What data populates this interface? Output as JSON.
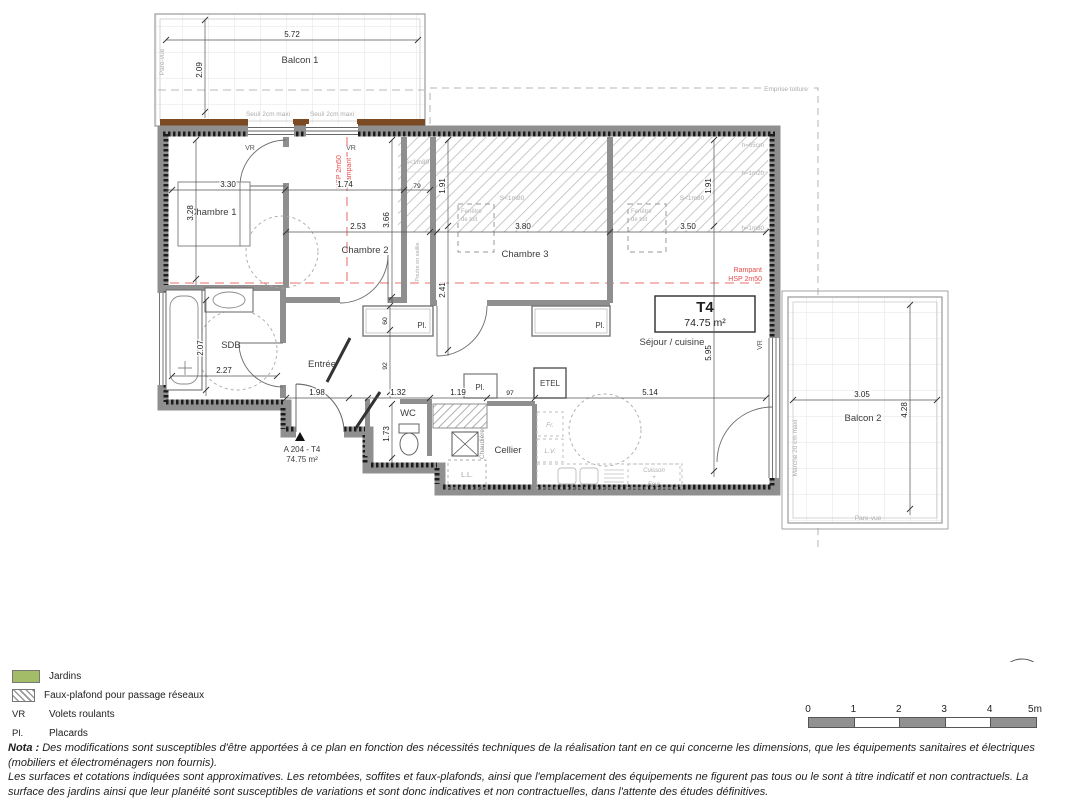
{
  "unit": {
    "type": "T4",
    "area": "74.75 m²",
    "ref": "A 204 - T4"
  },
  "rooms": {
    "balcon1": "Balcon 1",
    "balcon2": "Balcon 2",
    "chambre1": "Chambre 1",
    "chambre2": "Chambre 2",
    "chambre3": "Chambre 3",
    "sdb": "SDB",
    "entree": "Entrée",
    "wc": "WC",
    "cellier": "Cellier",
    "sejour": "Séjour / cuisine",
    "etel": "ETEL"
  },
  "fixtures": {
    "chaudiere": "Chaudière",
    "ll": "L.L.",
    "fr": "Fr.",
    "lv": "L.V.",
    "cuisson": "Cuisson",
    "plus": "+",
    "four": "Four"
  },
  "dims": {
    "b1w": "5.72",
    "b1h": "2.09",
    "c1w": "3.30",
    "c1h": "3.28",
    "d174": "1.74",
    "d79": "79",
    "c2w": "2.53",
    "c2h": "3.66",
    "d191": "1.91",
    "d241": "2.41",
    "c3w": "3.80",
    "sejw": "3.50",
    "sdbh": "2.07",
    "sdbw": "2.27",
    "d198": "1.98",
    "wcw": "1.32",
    "wch": "1.73",
    "d119": "1.19",
    "d97": "97",
    "d514": "5.14",
    "d60": "60",
    "d92": "92",
    "sejh": "5.95",
    "b2w": "3.05",
    "b2h": "4.28"
  },
  "annotations": {
    "seuil": "Seuil 2cm maxi",
    "pare_vue": "Pare-vue",
    "marche": "Marche 20 cm maxi",
    "emprise": "Emprise toiture",
    "s1m80": "S<1m80",
    "h65": "h=65cm",
    "h120": "h=1m20",
    "h180": "h=1m80",
    "fenetre_l1": "Fenêtre",
    "fenetre_l2": "de toit",
    "poutre": "Poutre en saillie",
    "vr": "VR",
    "pl": "Pl."
  },
  "rampant": {
    "hsp": "HSP 2m50",
    "label": "Rampant"
  },
  "legend": {
    "jardins": "Jardins",
    "faux_plafond": "Faux-plafond pour passage réseaux",
    "vr_abbr": "VR",
    "vr_label": "Volets roulants",
    "pl_abbr": "Pl.",
    "pl_label": "Placards"
  },
  "nota": {
    "prefix": "Nota :",
    "l1": "Des modifications sont susceptibles d'être apportées à ce plan en fonction des nécessités techniques de la réalisation tant en ce qui concerne les dimensions, que les équipements sanitaires et électriques",
    "l2": "(mobiliers et électroménagers non fournis).",
    "l3": "Les surfaces et cotations indiquées sont approximatives. Les retombées, soffites et faux-plafonds, ainsi que l'emplacement des équipements ne figurent pas tous ou le sont à titre indicatif et non contractuels. La surface des jardins ainsi que leur planéité sont susceptibles de variations et sont donc indicatives et non contractuelles, dans l'attente des études définitives."
  },
  "scalebar": {
    "t0": "0",
    "t1": "1",
    "t2": "2",
    "t3": "3",
    "t4": "4",
    "t5": "5m"
  },
  "north": {
    "n": "N"
  },
  "colors": {
    "jardin_green": "#a2bc68",
    "wall_gray": "#8f8f8f",
    "rampant_red": "#e84b4b",
    "deck_brown": "#7b4a22"
  }
}
